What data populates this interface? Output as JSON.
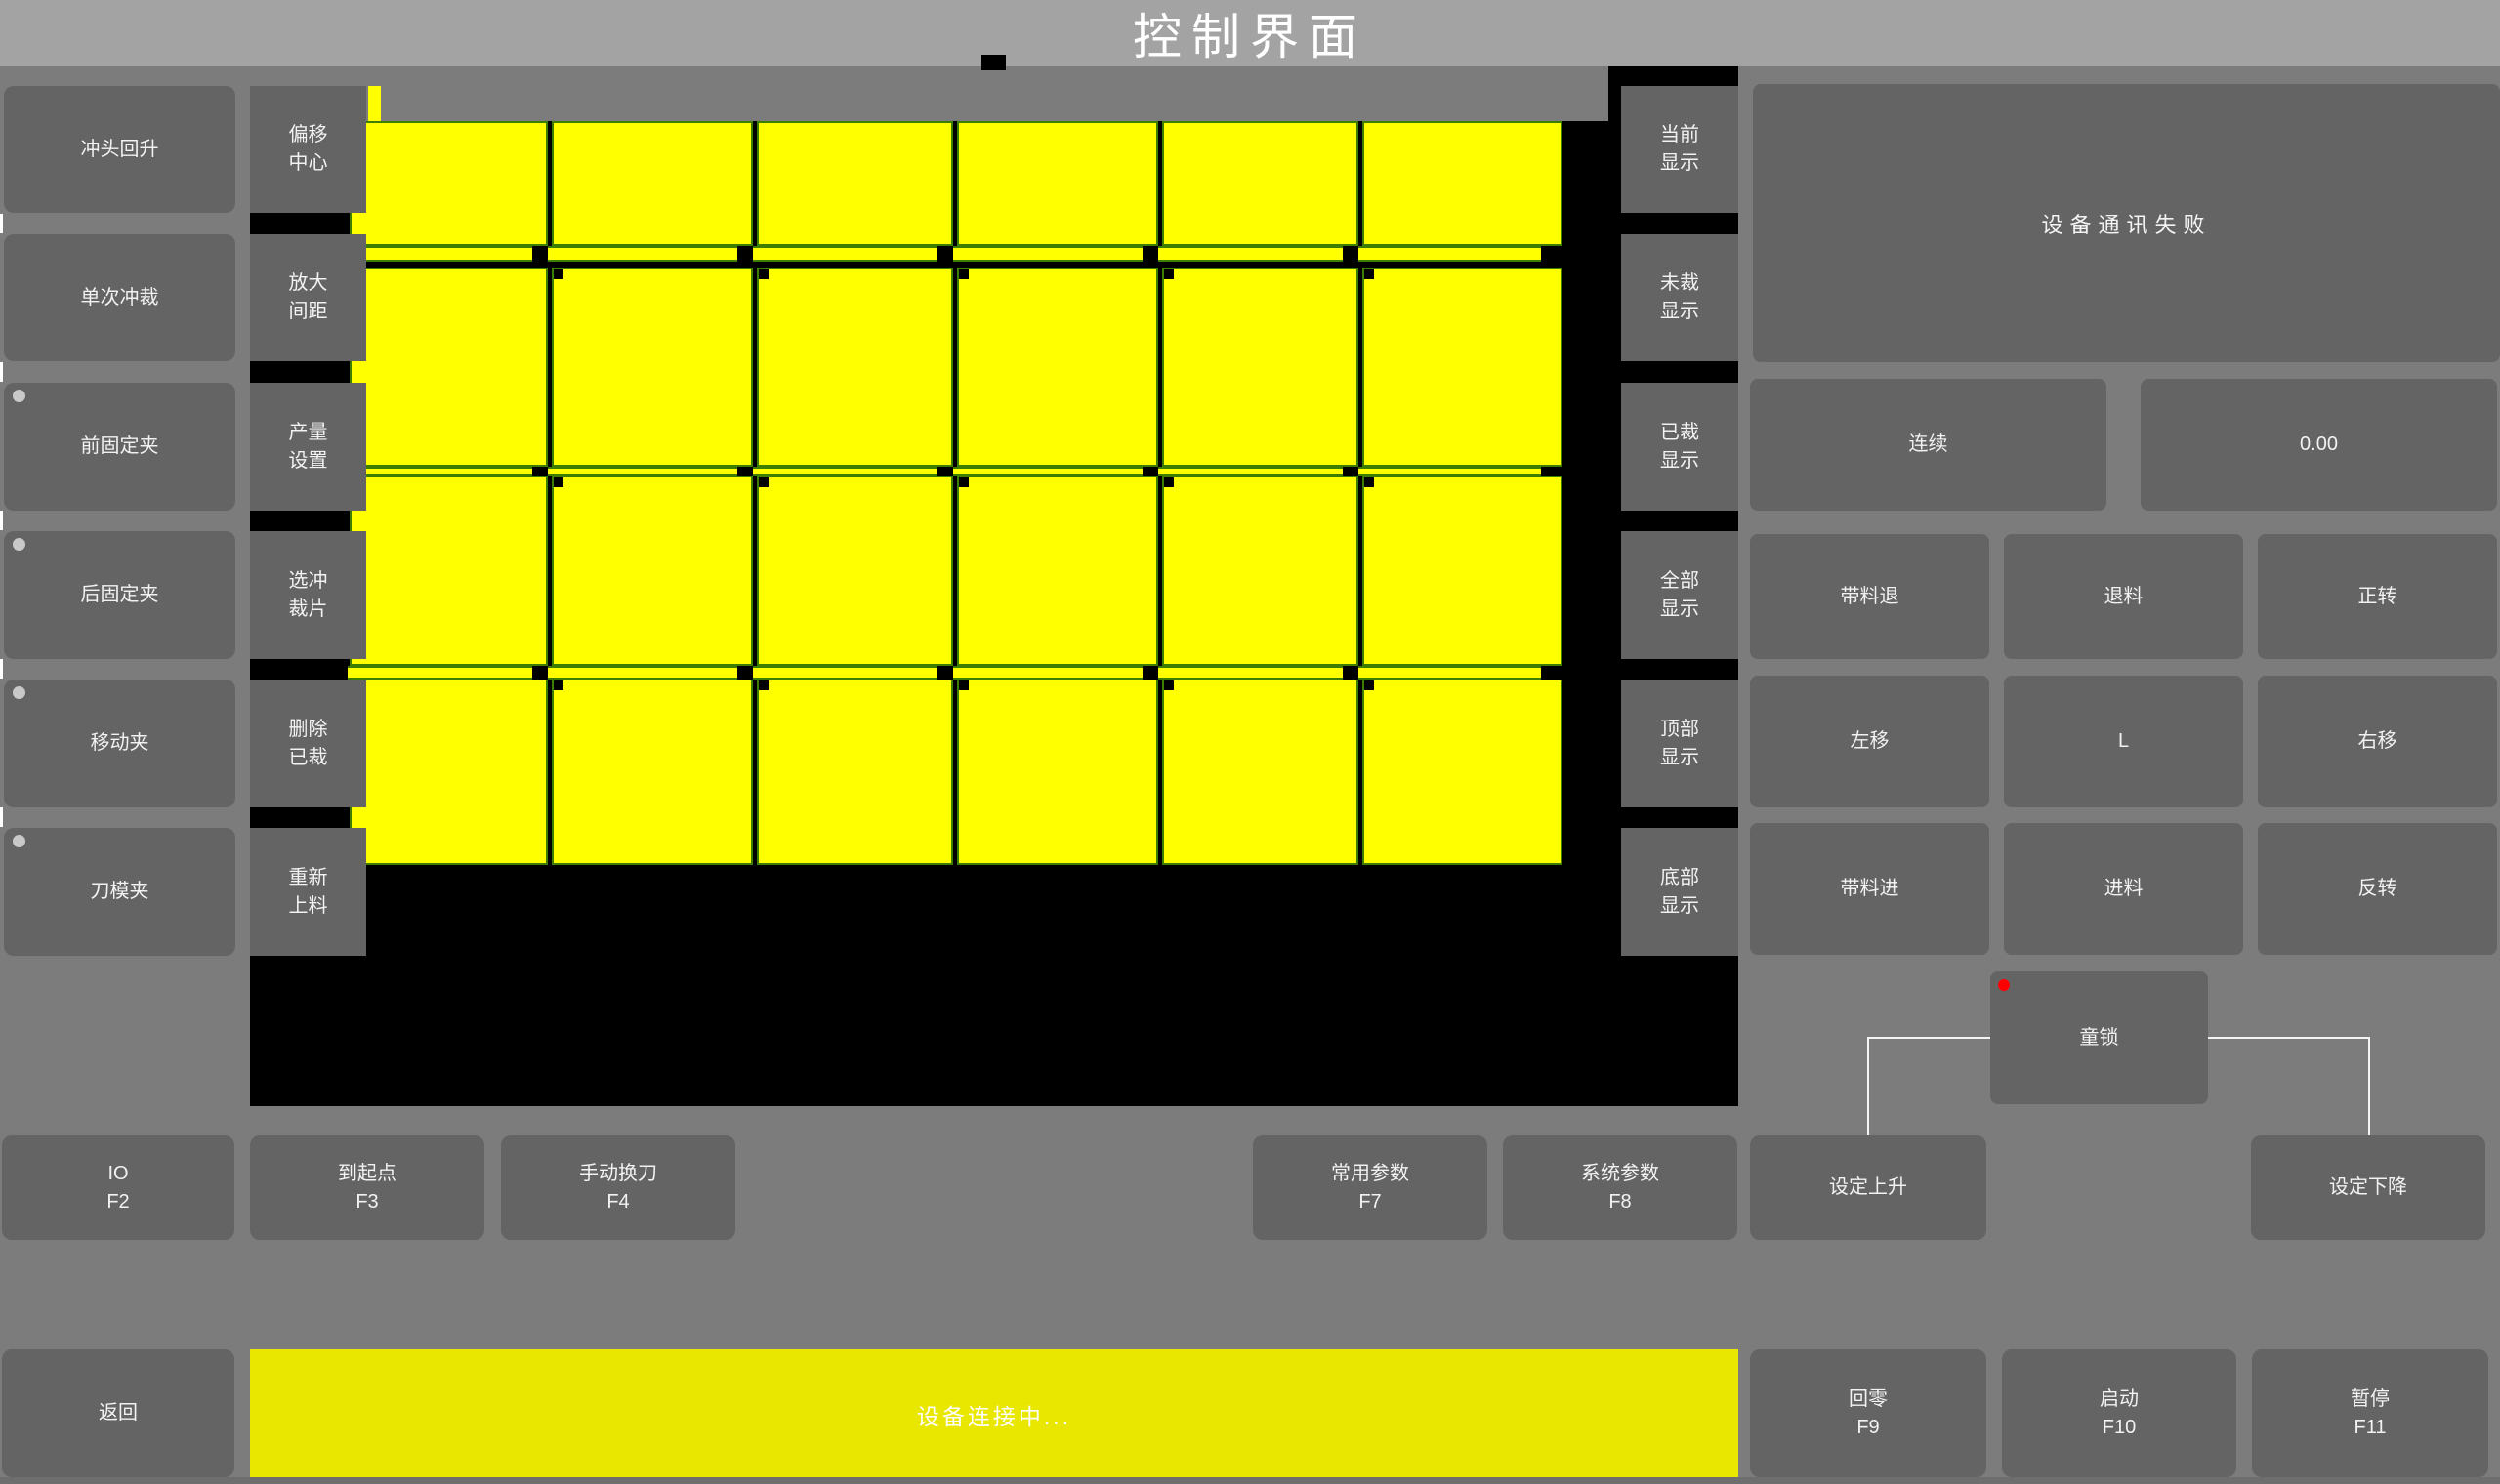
{
  "title": "控制界面",
  "colors": {
    "background": "#7c7c7c",
    "titlebar": "#a3a3a3",
    "button": "#646464",
    "piece_yellow": "#ffff00",
    "piece_border_green": "#3d7e00",
    "status_yellow": "#e9e600",
    "alert_red": "#ff0000"
  },
  "left_buttons": [
    {
      "label": "冲头回升",
      "indicator": false
    },
    {
      "label": "单次冲裁",
      "indicator": false
    },
    {
      "label": "前固定夹",
      "indicator": true
    },
    {
      "label": "后固定夹",
      "indicator": true
    },
    {
      "label": "移动夹",
      "indicator": true
    },
    {
      "label": "刀模夹",
      "indicator": true
    }
  ],
  "tool_buttons": [
    {
      "line1": "偏移",
      "line2": "中心"
    },
    {
      "line1": "放大",
      "line2": "间距"
    },
    {
      "line1": "产量",
      "line2": "设置"
    },
    {
      "line1": "选冲",
      "line2": "裁片"
    },
    {
      "line1": "删除",
      "line2": "已裁"
    },
    {
      "line1": "重新",
      "line2": "上料"
    }
  ],
  "display_buttons": [
    {
      "line1": "当前",
      "line2": "显示"
    },
    {
      "line1": "未裁",
      "line2": "显示"
    },
    {
      "line1": "已裁",
      "line2": "显示"
    },
    {
      "line1": "全部",
      "line2": "显示"
    },
    {
      "line1": "顶部",
      "line2": "显示"
    },
    {
      "line1": "底部",
      "line2": "显示"
    }
  ],
  "canvas": {
    "grid_rows": 4,
    "grid_columns": 6
  },
  "right_panel": {
    "message": "设备通讯失败",
    "mode": "连续",
    "value": "0.00",
    "jog_buttons": [
      "带料退",
      "退料",
      "正转",
      "左移",
      "L",
      "右移",
      "带料进",
      "进料",
      "反转"
    ],
    "child_lock": "童锁"
  },
  "function_row": [
    {
      "label": "IO",
      "key": "F2"
    },
    {
      "label": "到起点",
      "key": "F3"
    },
    {
      "label": "手动换刀",
      "key": "F4"
    },
    {
      "label": "常用参数",
      "key": "F7"
    },
    {
      "label": "系统参数",
      "key": "F8"
    },
    {
      "label": "设定上升",
      "key": ""
    },
    {
      "label": "设定下降",
      "key": ""
    }
  ],
  "bottom_bar": {
    "back": "返回",
    "status": "设备连接中...",
    "buttons": [
      {
        "label": "回零",
        "key": "F9"
      },
      {
        "label": "启动",
        "key": "F10"
      },
      {
        "label": "暂停",
        "key": "F11"
      }
    ]
  }
}
